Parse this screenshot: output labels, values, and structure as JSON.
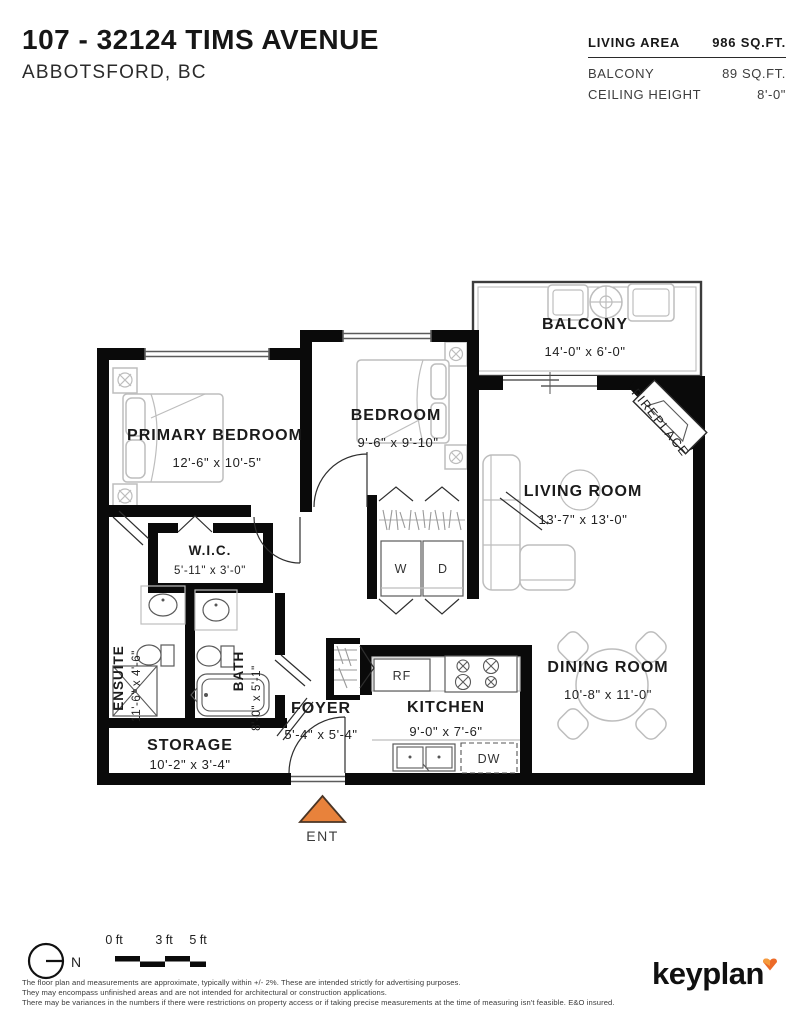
{
  "header": {
    "address": "107 - 32124 TIMS AVENUE",
    "city": "ABBOTSFORD, BC"
  },
  "stats": {
    "living_area_label": "LIVING AREA",
    "living_area_value": "986 SQ.FT.",
    "balcony_label": "BALCONY",
    "balcony_value": "89 SQ.FT.",
    "ceiling_label": "CEILING HEIGHT",
    "ceiling_value": "8'-0\""
  },
  "rooms": {
    "primary_bedroom": {
      "name": "PRIMARY BEDROOM",
      "dims": "12'-6\" x 10'-5\""
    },
    "bedroom": {
      "name": "BEDROOM",
      "dims": "9'-6\" x 9'-10\""
    },
    "living_room": {
      "name": "LIVING ROOM",
      "dims": "13'-7\" x 13'-0\""
    },
    "dining_room": {
      "name": "DINING ROOM",
      "dims": "10'-8\" x 11'-0\""
    },
    "kitchen": {
      "name": "KITCHEN",
      "dims": "9'-0\" x 7'-6\""
    },
    "foyer": {
      "name": "FOYER",
      "dims": "5'-4\" x 5'-4\""
    },
    "storage": {
      "name": "STORAGE",
      "dims": "10'-2\" x 3'-4\""
    },
    "wic": {
      "name": "W.I.C.",
      "dims": "5'-11\" x 3'-0\""
    },
    "ensuite": {
      "name": "ENSUITE",
      "dims": "11'-6\" x 4'-6\""
    },
    "bath": {
      "name": "BATH",
      "dims": "8'-0\" x 5'-1\""
    },
    "balcony": {
      "name": "BALCONY",
      "dims": "14'-0\" x 6'-0\""
    }
  },
  "fixtures": {
    "washer": "W",
    "dryer": "D",
    "fridge": "RF",
    "dishwasher": "DW",
    "fireplace": "FIREPLACE",
    "entry": "ENT"
  },
  "footer": {
    "north": "N",
    "scale_ticks": [
      "0 ft",
      "3 ft",
      "5 ft"
    ],
    "disclaimer": [
      "The floor plan and measurements are approximate, typically within +/- 2%. These are intended strictly for advertising purposes.",
      "They may encompass unfinished areas and are not intended for architectural or construction applications.",
      "There may be variances in the numbers if there were restrictions on property access or if taking precise measurements at the time of measuring isn't feasible. E&O insured."
    ],
    "brand": "keyplan"
  },
  "colors": {
    "accent_orange": "#e8823b",
    "wall_black": "#0a0a0a",
    "furniture_gray": "#bdbdbd"
  }
}
